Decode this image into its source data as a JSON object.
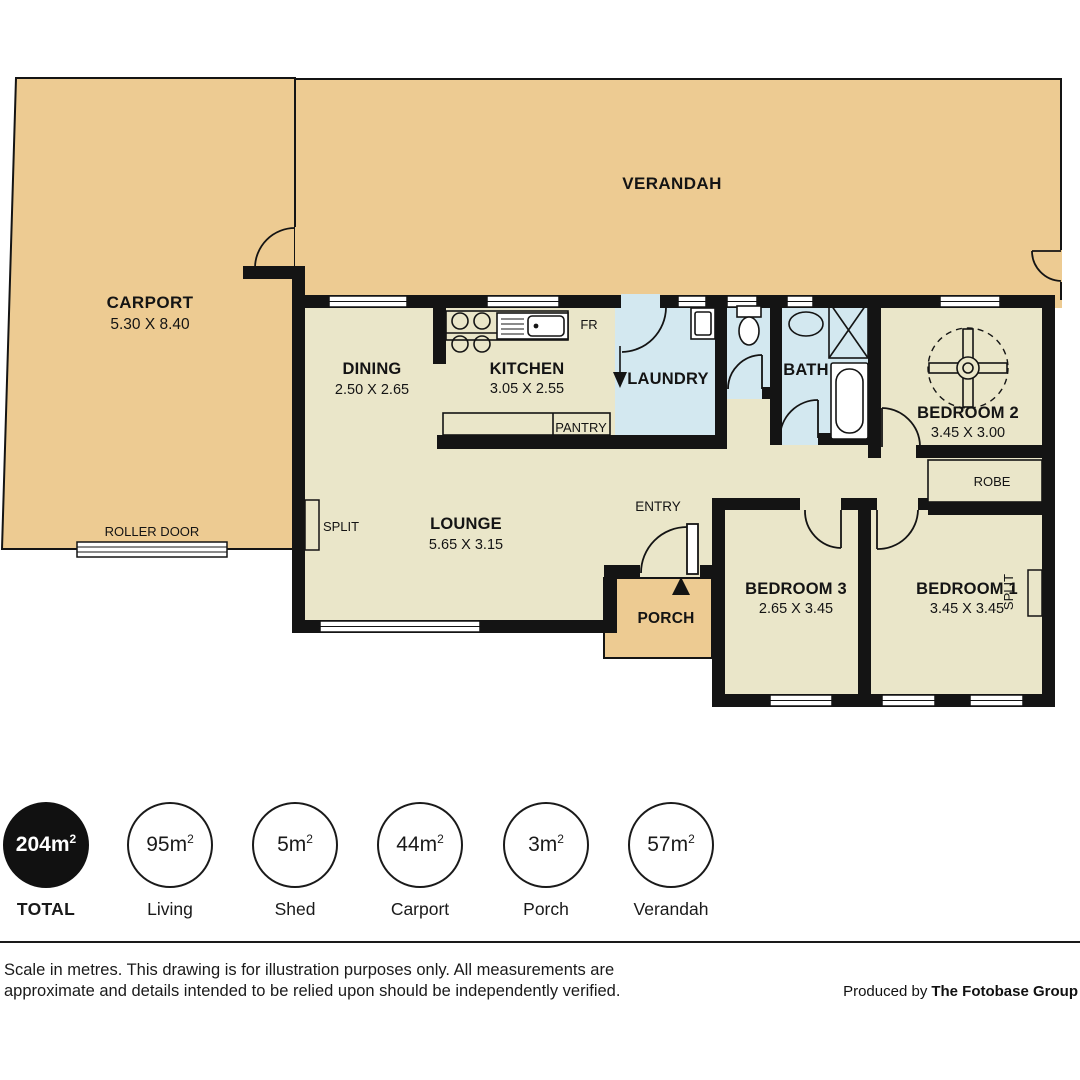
{
  "plan": {
    "verandah_label": "VERANDAH",
    "carport_label": "CARPORT",
    "carport_dims": "5.30 X 8.40",
    "roller_door_label": "ROLLER DOOR",
    "dining_label": "DINING",
    "dining_dims": "2.50 X 2.65",
    "kitchen_label": "KITCHEN",
    "kitchen_dims": "3.05 X 2.55",
    "fr_label": "FR",
    "pantry_label": "PANTRY",
    "laundry_label": "LAUNDRY",
    "bath_label": "BATH",
    "bedroom2_label": "BEDROOM 2",
    "bedroom2_dims": "3.45 X 3.00",
    "robe_label": "ROBE",
    "lounge_label": "LOUNGE",
    "lounge_dims": "5.65 X 3.15",
    "split_lounge_label": "SPLIT",
    "split_bed1_label": "SPLIT",
    "entry_label": "ENTRY",
    "porch_label": "PORCH",
    "bedroom3_label": "BEDROOM 3",
    "bedroom3_dims": "2.65 X 3.45",
    "bedroom1_label": "BEDROOM 1",
    "bedroom1_dims": "3.45 X 3.45"
  },
  "stats": [
    {
      "value": "204m",
      "sup": "2",
      "label": "TOTAL"
    },
    {
      "value": "95m",
      "sup": "2",
      "label": "Living"
    },
    {
      "value": "5m",
      "sup": "2",
      "label": "Shed"
    },
    {
      "value": "44m",
      "sup": "2",
      "label": "Carport"
    },
    {
      "value": "3m",
      "sup": "2",
      "label": "Porch"
    },
    {
      "value": "57m",
      "sup": "2",
      "label": "Verandah"
    }
  ],
  "footer": {
    "disclaimer_line1": "Scale in metres. This drawing is for illustration purposes only. All measurements are",
    "disclaimer_line2": "approximate and details intended to be relied upon should be independently verified.",
    "produced_prefix": "Produced by",
    "producer": "The Fotobase Group"
  },
  "colors": {
    "outdoor_tan": "#edcb92",
    "interior_cream": "#eae6c9",
    "wet_area_blue": "#d3e8f0",
    "wall_black": "#141414"
  }
}
